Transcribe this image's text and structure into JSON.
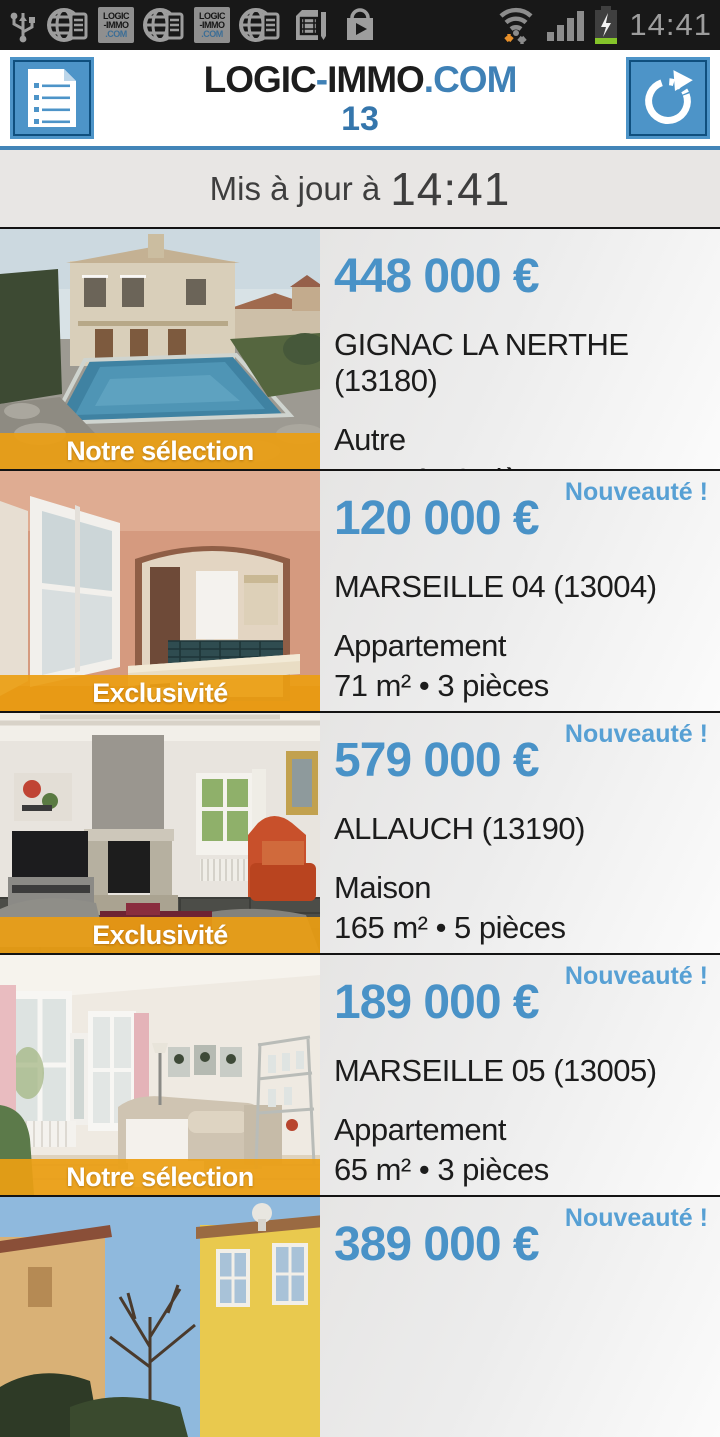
{
  "status_bar": {
    "time": "14:41",
    "left_icons": [
      "usb-icon",
      "browser-notification-icon",
      "logic-immo-app-icon",
      "browser-notification-icon",
      "logic-immo-app-icon",
      "browser-notification-icon",
      "sim-card-icon",
      "play-store-icon"
    ],
    "right_icons": [
      "wifi-traffic-icon",
      "signal-strength-icon",
      "battery-charging-icon"
    ],
    "app_badge": {
      "line1": "LOGIC",
      "line2": "-IMMO",
      "line3": ".COM"
    }
  },
  "header": {
    "title_part1": "LOGIC",
    "title_dash": "-",
    "title_part2": "IMMO",
    "title_suffix": ".COM",
    "department": "13",
    "list_button": "listing-menu",
    "refresh_button": "refresh"
  },
  "update_banner": {
    "label": "Mis à jour à",
    "time": "14:41"
  },
  "listings": [
    {
      "price": "448 000 €",
      "location": "GIGNAC LA NERTHE (13180)",
      "type": "Autre",
      "details": "145 m² • 6 pièces",
      "badge": "Notre sélection",
      "photo": "house-with-pool"
    },
    {
      "price": "120 000 €",
      "location": "MARSEILLE 04 (13004)",
      "type": "Appartement",
      "details": "71 m² • 3 pièces",
      "badge": "Exclusivité",
      "new_label": "Nouveauté !",
      "photo": "apartment-interior-kitchen"
    },
    {
      "price": "579 000 €",
      "location": "ALLAUCH (13190)",
      "type": "Maison",
      "details": "165 m² • 5 pièces",
      "badge": "Exclusivité",
      "new_label": "Nouveauté !",
      "photo": "living-room-fireplace"
    },
    {
      "price": "189 000 €",
      "location": "MARSEILLE 05 (13005)",
      "type": "Appartement",
      "details": "65 m² • 3 pièces",
      "badge": "Notre sélection",
      "new_label": "Nouveauté !",
      "photo": "bright-living-room"
    },
    {
      "price": "389 000 €",
      "new_label": "Nouveauté !",
      "photo": "yellow-house"
    }
  ],
  "colors": {
    "price_blue": "#4992c7",
    "nouveaute_blue": "#57a0d4",
    "badge_orange": "#eb9e12",
    "header_accent_blue": "#4285b8",
    "button_blue": "#4d94c8",
    "status_bar_bg": "#181818"
  }
}
